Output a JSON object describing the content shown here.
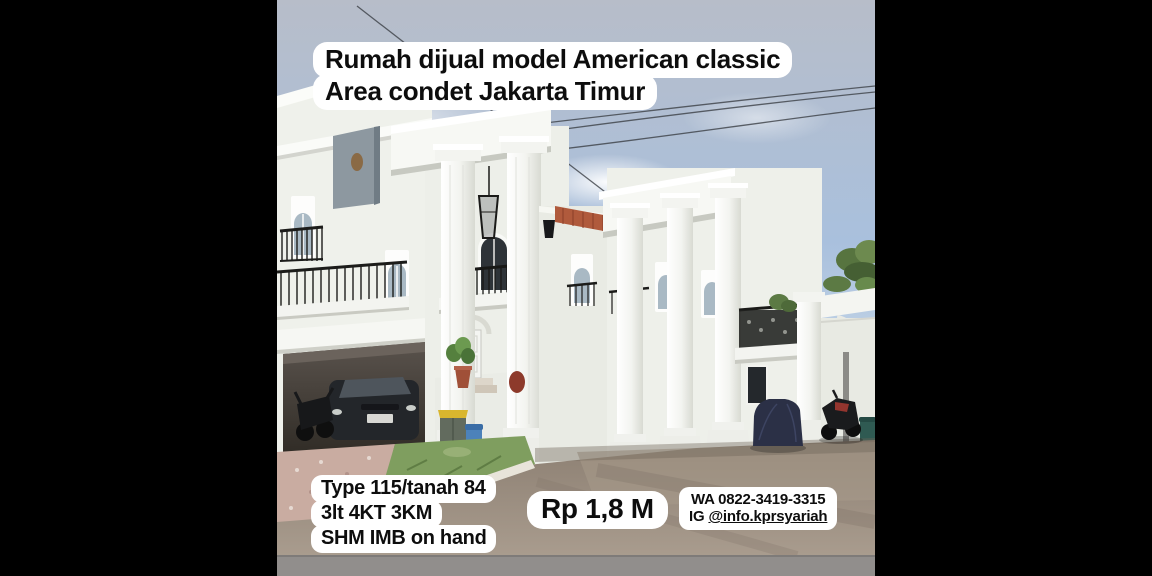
{
  "labels": {
    "title": {
      "line1": "Rumah dijual model American classic",
      "line2": "Area condet Jakarta Timur"
    },
    "specs": {
      "line1": "Type 115/tanah 84",
      "line2": "3lt 4KT 3KM",
      "line3": "SHM IMB on hand"
    },
    "price": "Rp 1,8 M",
    "contact": {
      "whatsapp": "WA 0822-3419-3315",
      "instagram_prefix": "IG",
      "instagram_handle": "@info.kprsyariah"
    }
  },
  "colors": {
    "background_bars": "#000000",
    "label_bg": "#ffffff",
    "label_text": "#0d0d0d",
    "sky_top": "#b7bdc9",
    "sky_blue": "#a9c0dd",
    "house_white": "#eff1eb",
    "column_shadow": "#d8dad2",
    "railing_iron": "#1c1c1a",
    "roof_tile_orange": "#b05a3c",
    "asphalt": "#9a8c7e",
    "pavers_pink": "#c9aca1",
    "grass_green": "#7f9e5f",
    "footer_strip": "#918e8c",
    "trash_bin_lid_yellow": "#d9b62e",
    "trash_bin_blue": "#4c82ba",
    "car_cover_navy": "#2b3046"
  }
}
